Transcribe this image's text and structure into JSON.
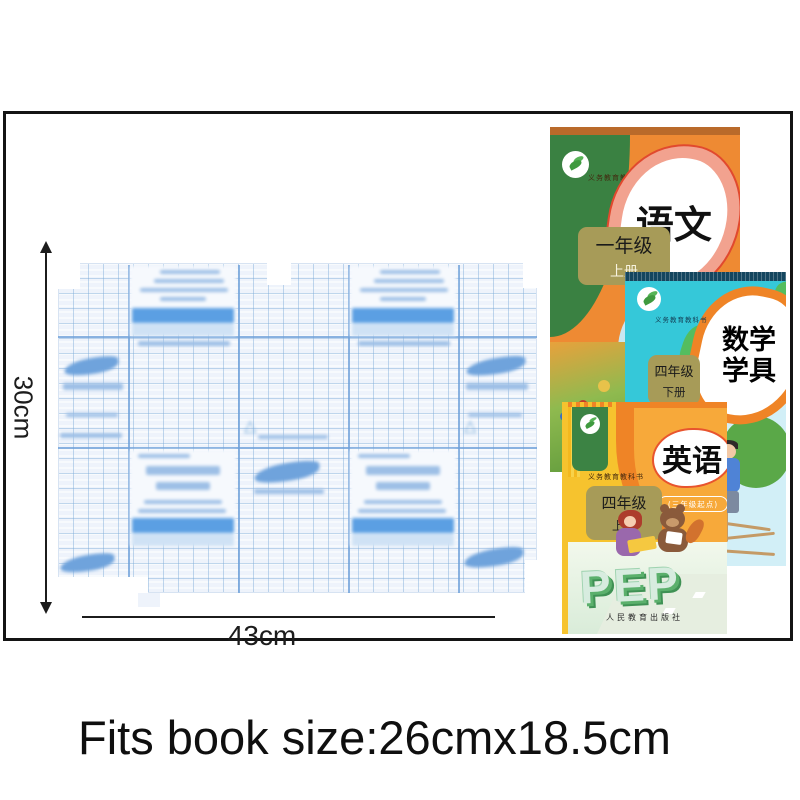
{
  "badge": {
    "label": "medium"
  },
  "header": {
    "size_label": "size :",
    "size_value": "30*43 cm",
    "quantity": "10pcs"
  },
  "dimensions": {
    "height": "30cm",
    "width": "43cm"
  },
  "footer": {
    "fits_text": "Fits book size:26cmx18.5cm"
  },
  "books": [
    {
      "title": "语文",
      "grade": "一年级",
      "volume": "上册",
      "series": "义务教育教科书"
    },
    {
      "title_line1": "数学",
      "title_line2": "学具",
      "grade": "四年级",
      "volume": "下册",
      "series": "义务教育教科书"
    },
    {
      "title": "英语",
      "subtitle": "(三年级起点)",
      "grade": "四年级",
      "volume": "上册",
      "series": "义务教育教科书",
      "brand": "PEP",
      "publisher": "人民教育出版社"
    }
  ],
  "colors": {
    "badge_bg": "#0d0d0d",
    "film_base": "#eef3fb",
    "film_band": "#5b9fe3",
    "book1_orange": "#ee8a33",
    "book2_cyan": "#35c8d9",
    "book3_yellow": "#f6c32e",
    "accent_orange": "#ef8426",
    "khaki": "#a79b58",
    "corner_green": "#3c8344"
  }
}
